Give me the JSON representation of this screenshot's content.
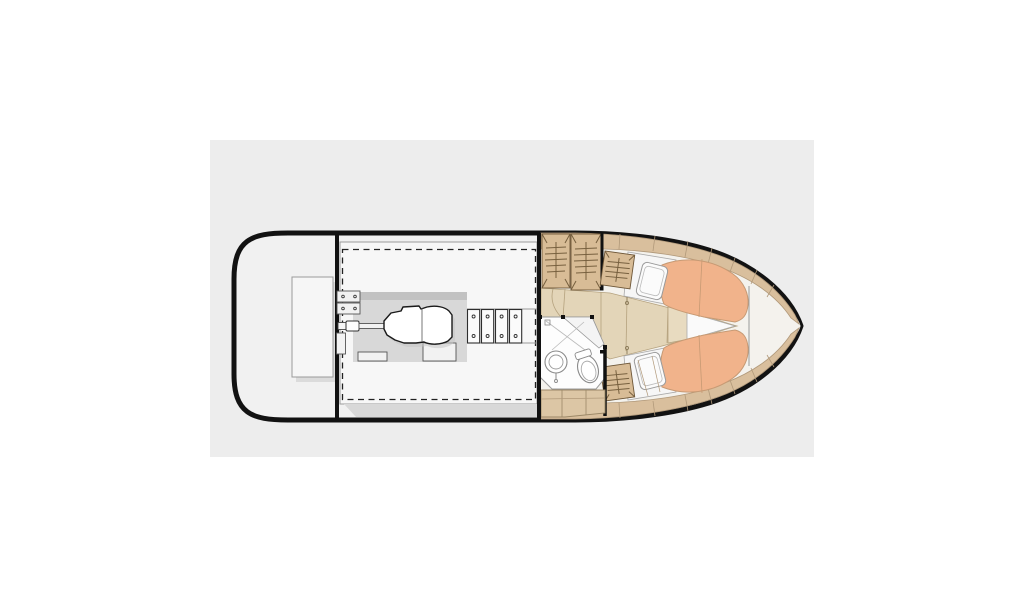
{
  "diagram": {
    "type": "boat-floor-plan",
    "description": "Top-view deck and cabin layout plan of a motor yacht, bow pointing right",
    "sections": [
      {
        "name": "swim-platform-stern",
        "label": "Aft deck with transom bench"
      },
      {
        "name": "engine-room",
        "label": "Engine compartment with inboard engine, shaft and floor hatches"
      },
      {
        "name": "cabin",
        "label": "Forward cabin with galley lockers, head and V-berth"
      },
      {
        "name": "head",
        "label": "Bathroom with sink and toilet"
      },
      {
        "name": "v-berth",
        "label": "Double V-berth with orange cushions and pillows"
      }
    ]
  },
  "colors": {
    "page_bg": "#ffffff",
    "stage_bg": "#ededed",
    "hull_fill": "#f1f1f1",
    "hull_stroke": "#121212",
    "panel_fill": "#f7f7f7",
    "panel_stroke": "#9b9b9b",
    "dash_stroke": "#222222",
    "bed_fill": "#d8d8d8",
    "bed_top_fill": "#c2c2c2",
    "white_fill": "#ffffff",
    "outline_dark": "#1a1a1a",
    "outline_mid": "#555555",
    "outline_light": "#9a9a9a",
    "shadow": "#c6c6c6",
    "floor_tan": "#e3d5b8",
    "floor_line": "#b5a27e",
    "locker_tan": "#d8bc96",
    "locker_line": "#77603f",
    "deck_tan": "#d9bf9d",
    "deck_line": "#b1997a",
    "berth_orange": "#f1b38b",
    "berth_line": "#c79a74",
    "pillow_fill": "#fbfbfb",
    "bath_fill": "#fdfdfd",
    "cabinet_tan": "#dcc6a5",
    "black": "#111111"
  }
}
